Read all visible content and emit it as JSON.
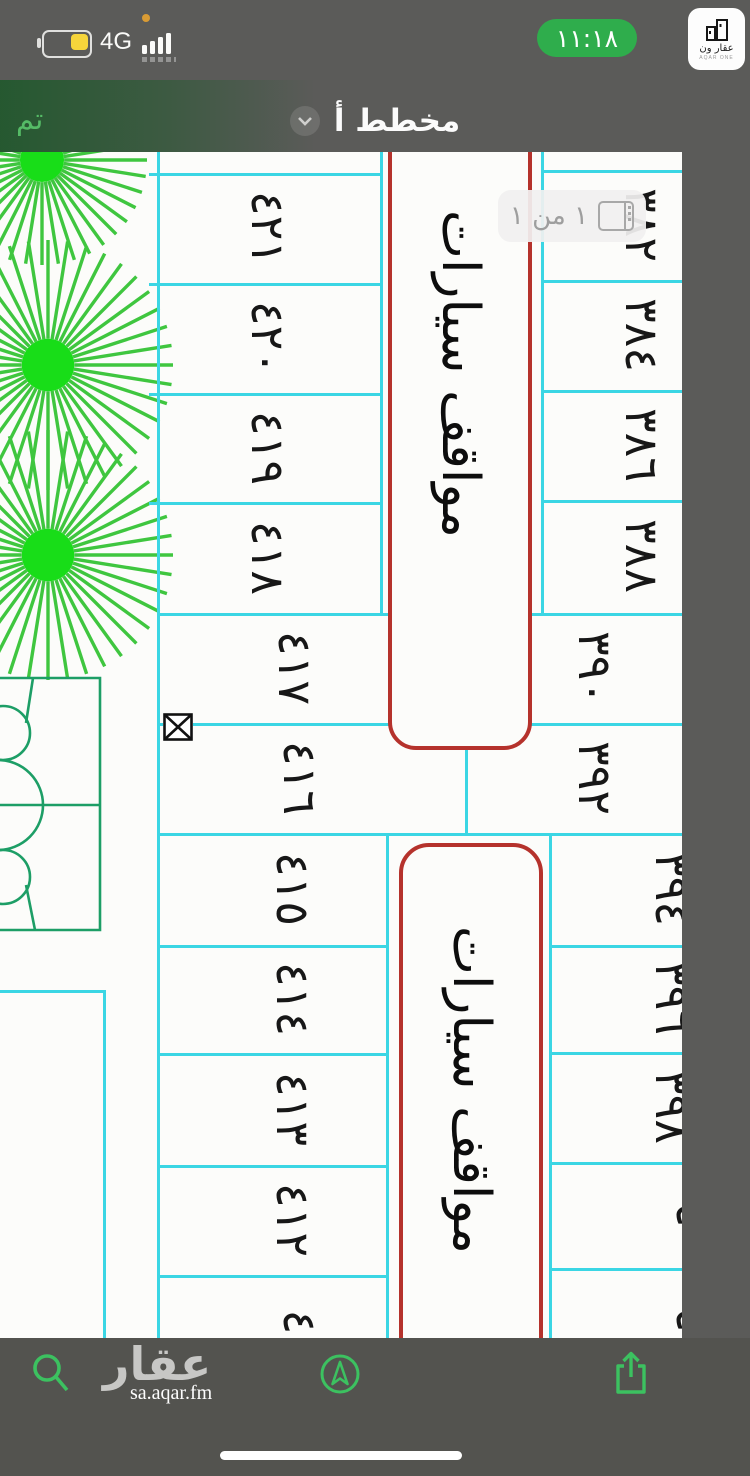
{
  "status_bar": {
    "network": "4G",
    "time": "١١:١٨"
  },
  "logo_card": {
    "title": "عقار ون",
    "subtitle": "AQAR ONE"
  },
  "nav": {
    "done": "تم",
    "title": "مخطط أ"
  },
  "page_indicator": {
    "label": "١ من ١"
  },
  "plan": {
    "parking_top": "مواقف سيارات",
    "parking_bottom": "مواقف سيارات",
    "left_top": [
      "٤٢١",
      "٤٢٠",
      "٤١٩",
      "٤١٨"
    ],
    "left_wide": [
      "٤١٧",
      "٤١٦"
    ],
    "left_lower": [
      "٤١٥",
      "٤١٤",
      "٤١٣",
      "٤١٢"
    ],
    "left_partial": "٤",
    "right_top": [
      "٣٨٢",
      "٣٨٤",
      "٣٨٦",
      "٣٨٨"
    ],
    "right_wide": [
      "٣٩٠",
      "٣٩٢"
    ],
    "right_lower": [
      "٣٩٤",
      "٣٩٦",
      "٣٩٨"
    ],
    "right_partials": [
      "٤",
      "٤"
    ]
  },
  "footer": {
    "brand": "عقار",
    "url": "sa.aqar.fm"
  },
  "colors": {
    "accent_green": "#2fad4c",
    "map_line_cyan": "#3bd6e4",
    "parking_red": "#b5322c",
    "tree_green": "#3fc63f",
    "court_green": "#1d9e66",
    "icon_green": "#3cc160"
  }
}
